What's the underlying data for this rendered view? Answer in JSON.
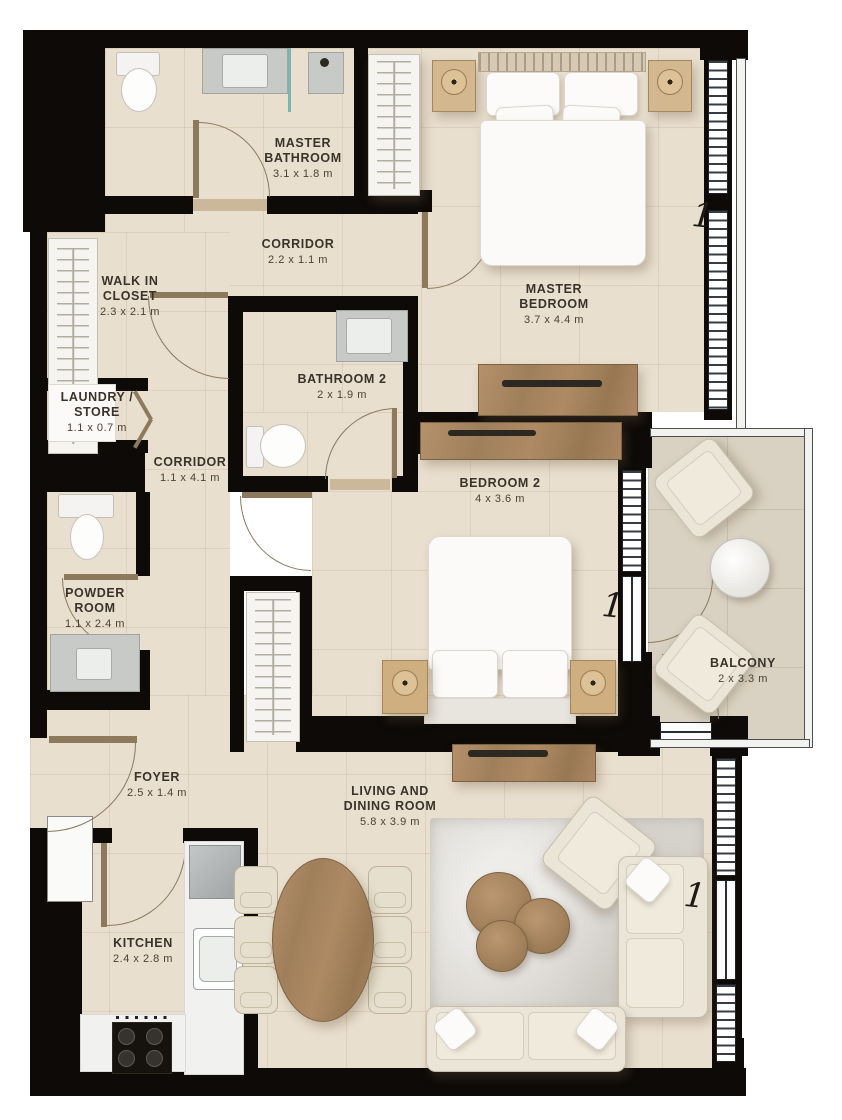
{
  "plan": {
    "rooms": [
      {
        "name": "MASTER BATHROOM",
        "dims": "3.1 x 1.8 m"
      },
      {
        "name": "CORRIDOR",
        "dims": "2.2 x 1.1 m"
      },
      {
        "name": "WALK IN CLOSET",
        "dims": "2.3 x 2.1 m"
      },
      {
        "name": "LAUNDRY / STORE",
        "dims": "1.1 x 0.7 m"
      },
      {
        "name": "BATHROOM 2",
        "dims": "2 x 1.9 m"
      },
      {
        "name": "MASTER BEDROOM",
        "dims": "3.7 x 4.4 m"
      },
      {
        "name": "CORRIDOR",
        "dims": "1.1 x 4.1 m"
      },
      {
        "name": "POWDER ROOM",
        "dims": "1.1 x 2.4 m"
      },
      {
        "name": "BEDROOM 2",
        "dims": "4 x 3.6 m"
      },
      {
        "name": "BALCONY",
        "dims": "2 x 3.3 m"
      },
      {
        "name": "FOYER",
        "dims": "2.5 x 1.4 m"
      },
      {
        "name": "LIVING AND DINING ROOM",
        "dims": "5.8 x 3.9 m"
      },
      {
        "name": "KITCHEN",
        "dims": "2.4 x 2.8 m"
      }
    ],
    "window_tags": [
      "1",
      "1",
      "1"
    ],
    "colors": {
      "wall": "#0d0a07",
      "floor": "#e9dfce",
      "balcony_floor": "#d9d1c2",
      "wood": "#a9855f",
      "label_text": "#3a332a"
    }
  }
}
